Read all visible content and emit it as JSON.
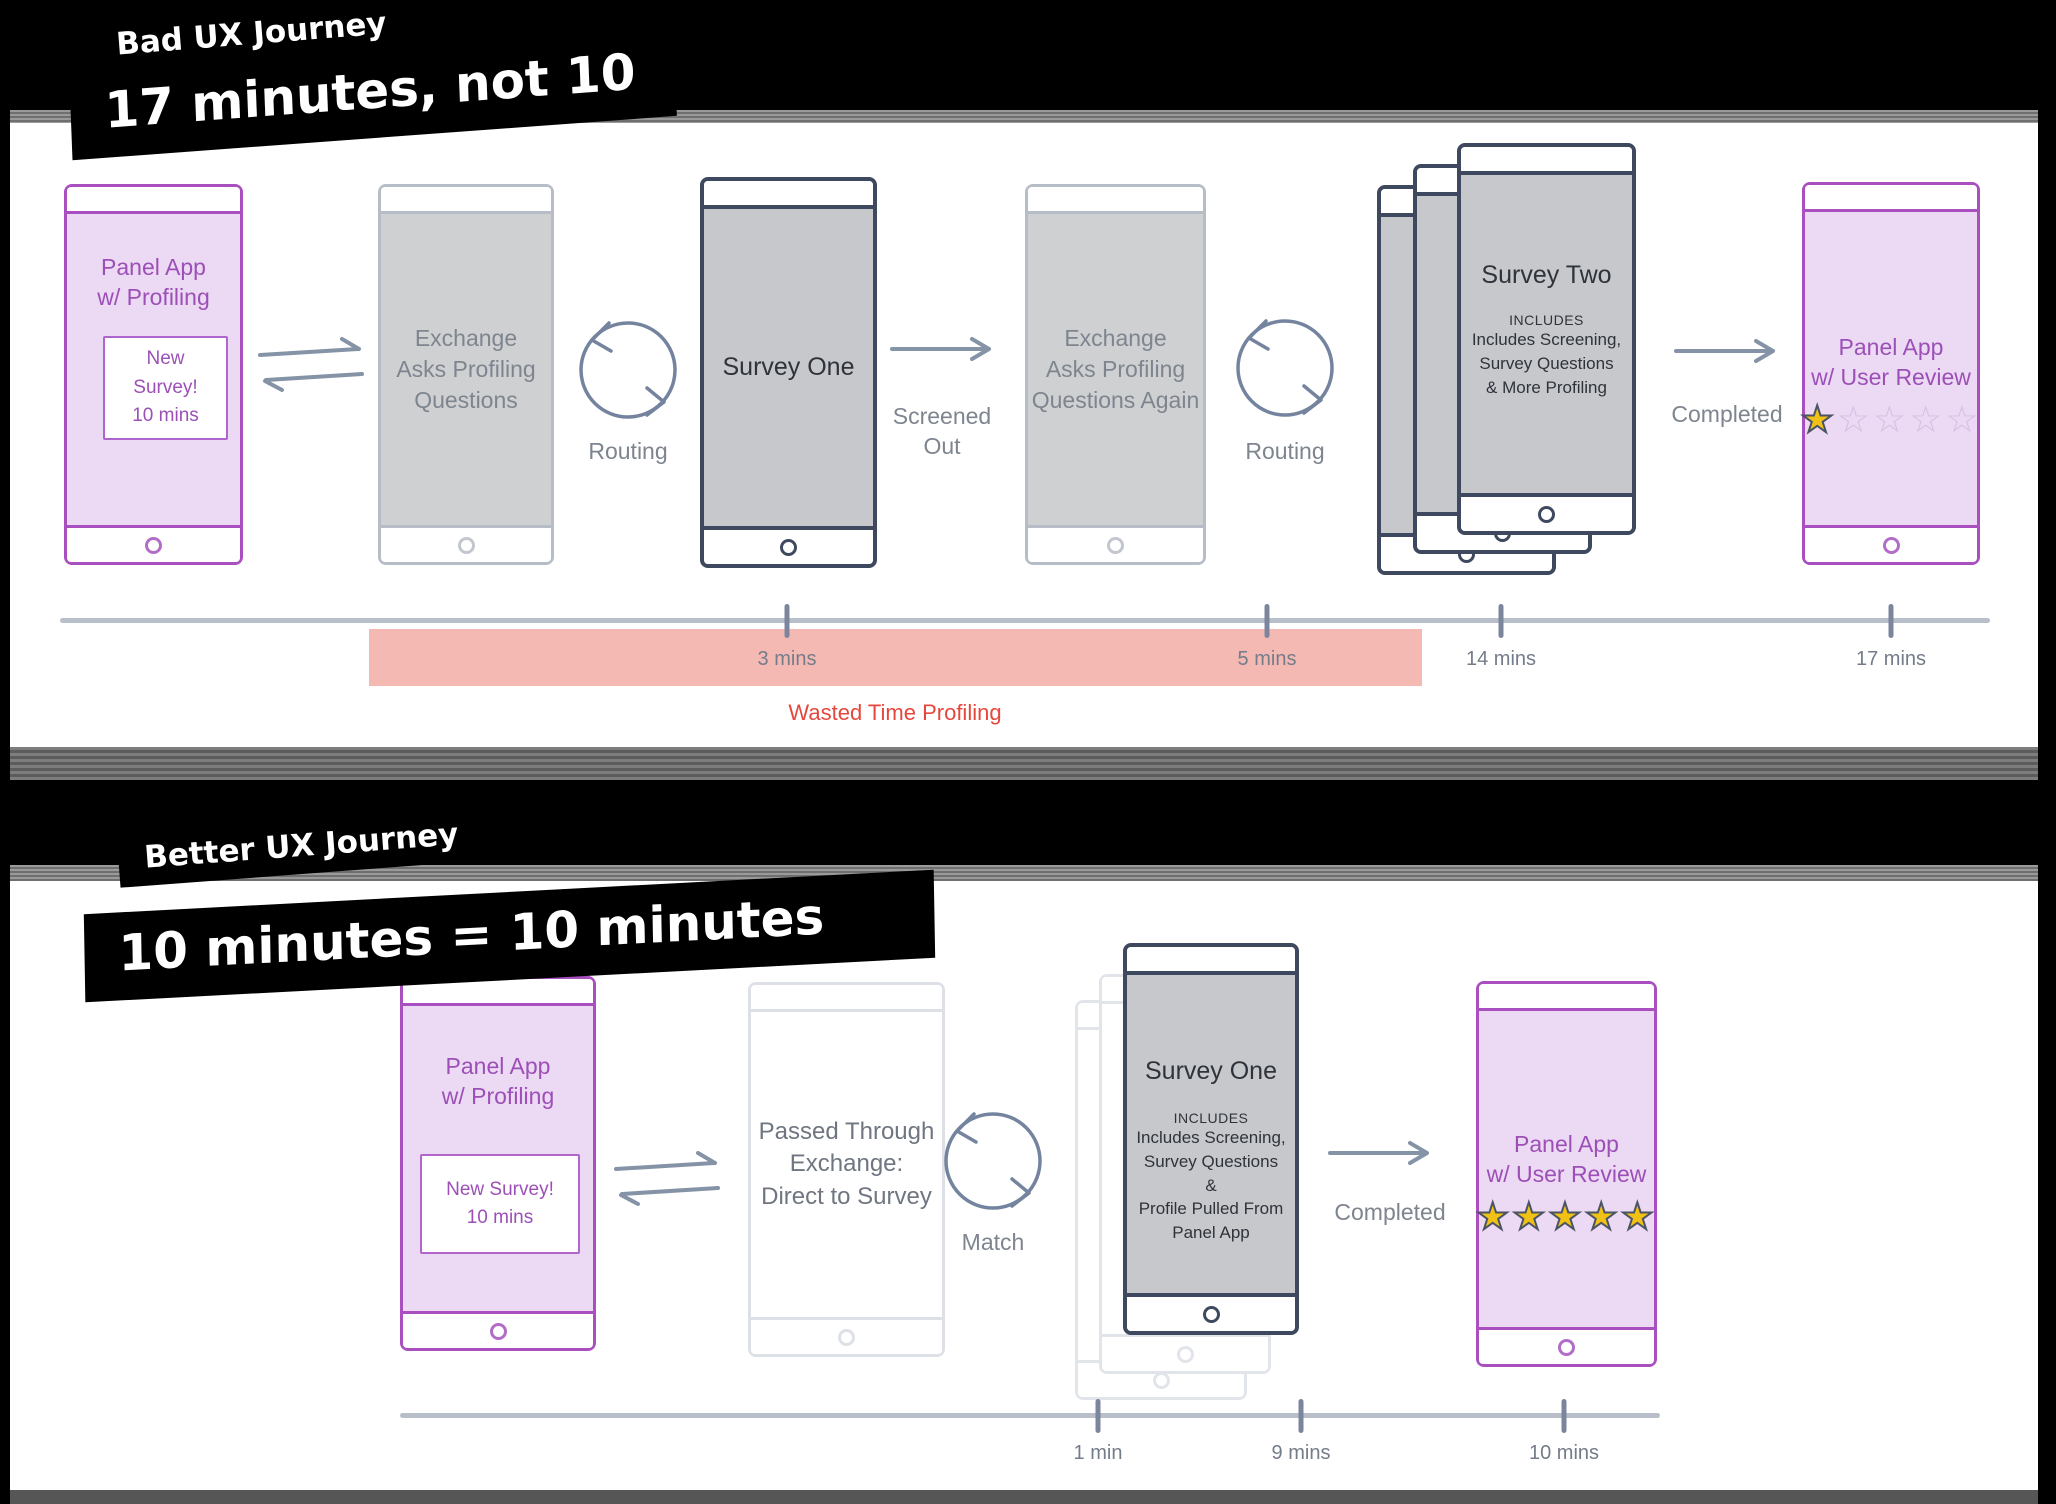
{
  "bad_journey": {
    "banner_label": "Bad UX Journey",
    "banner_title": "17 minutes, not 10",
    "panel_phone_title": "Panel App\nw/ Profiling",
    "panel_phone_card": "New Survey!\n10 mins",
    "exchange1_text": "Exchange\nAsks Profiling\nQuestions",
    "routing1_label": "Routing",
    "survey_one_title": "Survey One",
    "screened_out_label": "Screened\nOut",
    "exchange2_text": "Exchange\nAsks Profiling\nQuestions Again",
    "routing2_label": "Routing",
    "survey_two_title": "Survey Two",
    "survey_two_includes_heading": "INCLUDES",
    "survey_two_includes_body": "Includes Screening,\nSurvey Questions\n& More Profiling",
    "completed_label": "Completed",
    "review_phone_title": "Panel App\nw/ User Review",
    "review_stars": {
      "stars_filled": 1,
      "stars_total": 5
    },
    "timeline": {
      "tick_labels": [
        "3 mins",
        "5 mins",
        "14 mins",
        "17 mins"
      ],
      "wasted_label": "Wasted Time Profiling"
    }
  },
  "better_journey": {
    "banner_label": "Better UX Journey",
    "banner_title": "10 minutes = 10 minutes",
    "panel_phone_title": "Panel App\nw/ Profiling",
    "panel_phone_card": "New Survey!\n10 mins",
    "passthrough_text": "Passed Through\nExchange:\nDirect to Survey",
    "match_label": "Match",
    "survey_one_title": "Survey One",
    "survey_one_includes_heading": "INCLUDES",
    "survey_one_includes_body": "Includes Screening,\nSurvey Questions\n&\nProfile Pulled From\nPanel App",
    "completed_label": "Completed",
    "review_phone_title": "Panel App\nw/ User Review",
    "review_stars": {
      "stars_filled": 5,
      "stars_total": 5
    },
    "timeline": {
      "tick_labels": [
        "1 min",
        "9 mins",
        "10 mins"
      ]
    }
  }
}
